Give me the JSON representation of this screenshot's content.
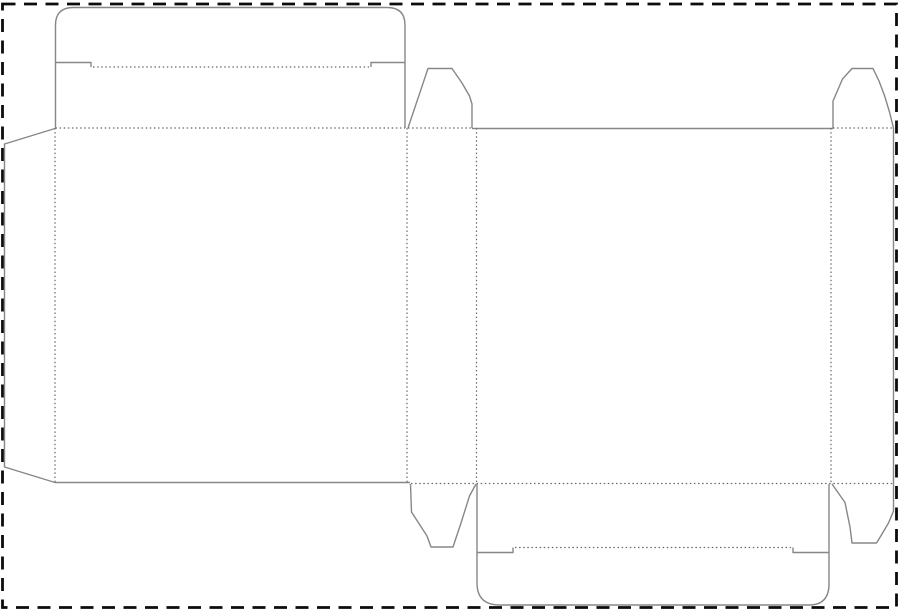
{
  "canvas": {
    "width": 900,
    "height": 614,
    "background": "#ffffff"
  },
  "artboard": {
    "name": "artboard-dashed-cut-border",
    "color": "#0c0c0c",
    "stroke_width": 2.8,
    "dash": "13 8.5",
    "x": 2.5,
    "y": 4,
    "w": 894,
    "h": 603.5
  },
  "dieline": {
    "cut_color": "#878787",
    "cut_width": 1.4,
    "crease_color": "#686868",
    "crease_width": 1.2,
    "crease_dash": "1.5 2.6",
    "cuts": [
      {
        "name": "top-tuck-flap-outline",
        "d": "M 55.5 128 L 55.5 25 Q 55.5 7.5 73.5 7.5 L 387 7.5 Q 405 7.5 405 25 L 405 128"
      },
      {
        "name": "top-tuck-flap-slit-left",
        "d": "M 55.5 62.5 L 91 62.5 L 91 67"
      },
      {
        "name": "top-tuck-flap-slit-right",
        "d": "M 405 62.5 L 371 62.5 L 371 67"
      },
      {
        "name": "top-dust-flap-left-outline",
        "d": "M 408 128 L 428 68.5 L 452 68.5 L 462 83 L 469.5 96 L 472 104 L 472 128"
      },
      {
        "name": "back-panel-top-edge",
        "d": "M 472 128.5 L 833 128.5"
      },
      {
        "name": "top-dust-flap-right-outline",
        "d": "M 833 128 L 833 101 L 842.5 79 L 852 68.5 L 873 68.5 L 879 81 L 884.5 95.5 L 889.5 112 L 893.5 128"
      },
      {
        "name": "right-side-and-bottom-dust-flap-right-cut",
        "d": "M 893.5 128 L 893.5 511 L 888.5 523 L 880.5 536.5 L 876.5 543 L 852 543 L 850 527 L 845 502.5 L 832 484"
      },
      {
        "name": "glue-flap-outline",
        "d": "M 55 128.5 L 4.5 144 L 4.5 467 L 55 482.5"
      },
      {
        "name": "front-panel-bottom-edge",
        "d": "M 55 482.5 L 410 482.5"
      },
      {
        "name": "bottom-dust-flap-left-outline",
        "d": "M 410.5 484 L 411.5 512 L 427 536 L 431 547 L 453 547 L 461 523 L 469.5 496 L 476 484"
      },
      {
        "name": "bottom-tuck-flap-outline",
        "d": "M 477 484 L 477 583 Q 477 605 500 605 L 809 605 Q 829 605 829 584 L 829 484"
      },
      {
        "name": "bottom-tuck-flap-slit-left",
        "d": "M 477 552.5 L 513 552.5 L 513 547.5"
      },
      {
        "name": "bottom-tuck-flap-slit-right",
        "d": "M 829 552.5 L 793 552.5 L 793 547.5"
      }
    ],
    "creases": [
      {
        "name": "fold-top-tuck-crease",
        "d": "M 93 67 L 369 67"
      },
      {
        "name": "fold-front-panel-top",
        "d": "M 55.5 128 L 405 128"
      },
      {
        "name": "fold-top-dust-flap-left",
        "d": "M 408 128 L 472 128"
      },
      {
        "name": "fold-top-dust-flap-right",
        "d": "M 833 128 L 893.5 128"
      },
      {
        "name": "fold-glue-flap",
        "d": "M 55 128 L 55 482.5"
      },
      {
        "name": "fold-front-to-side-panel",
        "d": "M 407 128 L 407 483.5"
      },
      {
        "name": "fold-side-to-back-panel",
        "d": "M 476.5 128 L 476.5 484"
      },
      {
        "name": "fold-back-to-right-side",
        "d": "M 831 128 L 831 483.5"
      },
      {
        "name": "fold-bottom-row",
        "d": "M 411 483.5 L 893.5 483.5"
      },
      {
        "name": "fold-bottom-tuck-crease",
        "d": "M 515 547.5 L 791 547.5"
      }
    ]
  }
}
